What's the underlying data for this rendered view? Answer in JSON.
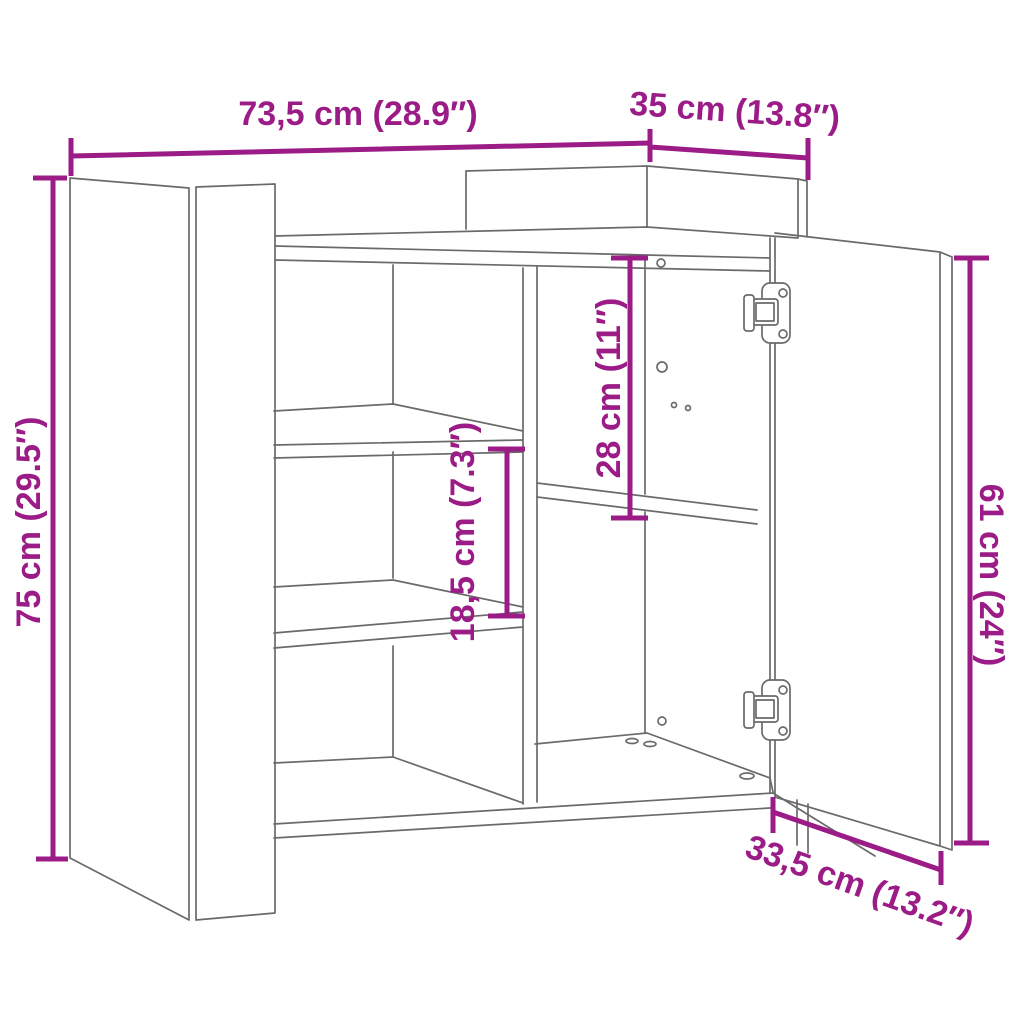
{
  "diagram": {
    "background_color": "#ffffff",
    "outline_color": "#6a6a6a",
    "dimension_color": "#9b1b87",
    "dimensions": {
      "width": {
        "label": "73,5 cm (28.9″)"
      },
      "depth": {
        "label": "35 cm (13.8″)"
      },
      "height": {
        "label": "75 cm (29.5″)"
      },
      "shelf_spacing": {
        "label": "18,5 cm (7.3″)"
      },
      "upper_compartment": {
        "label": "28 cm (11″)"
      },
      "door_height": {
        "label": "61 cm (24″)"
      },
      "door_width": {
        "label": "33,5 cm (13.2″)"
      }
    }
  }
}
